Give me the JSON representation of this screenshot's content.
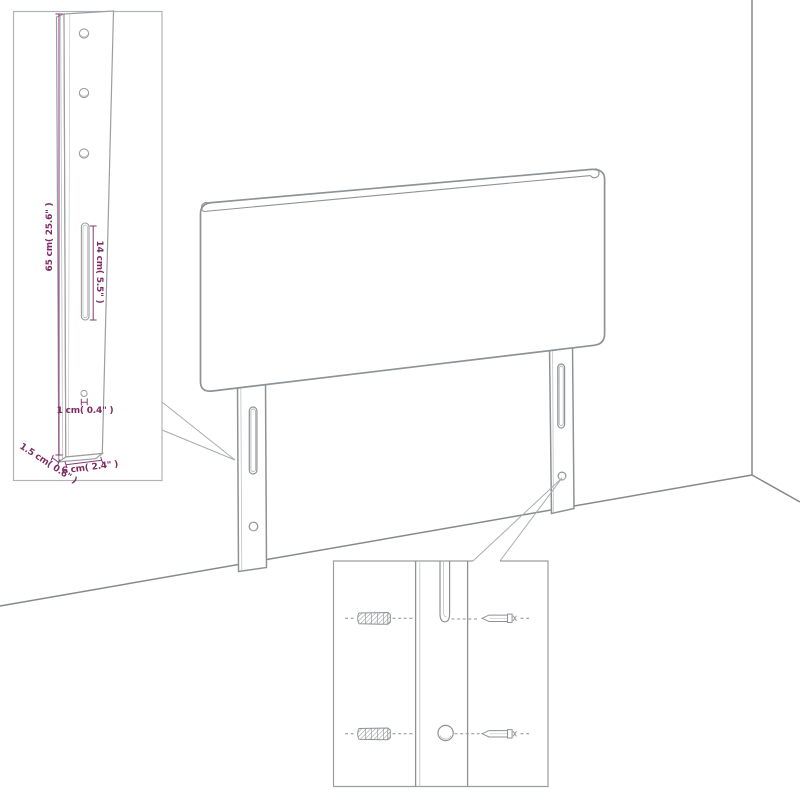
{
  "colors": {
    "accent_dimension_text": "#7d2b63",
    "dimension_line": "#8a3a74",
    "drawing_line": "#8e9296",
    "wall_line": "#85898d",
    "inset_border": "#b0b3b6",
    "background": "#ffffff"
  },
  "leg_detail_inset": {
    "dims": {
      "height": "65 cm( 25.6\" )",
      "slot": "14 cm( 5.5\" )",
      "hole": "1 cm( 0.4\" )",
      "width": "6 cm( 2.4\" )",
      "depth": "1.5 cm( 0.6\" )"
    }
  }
}
